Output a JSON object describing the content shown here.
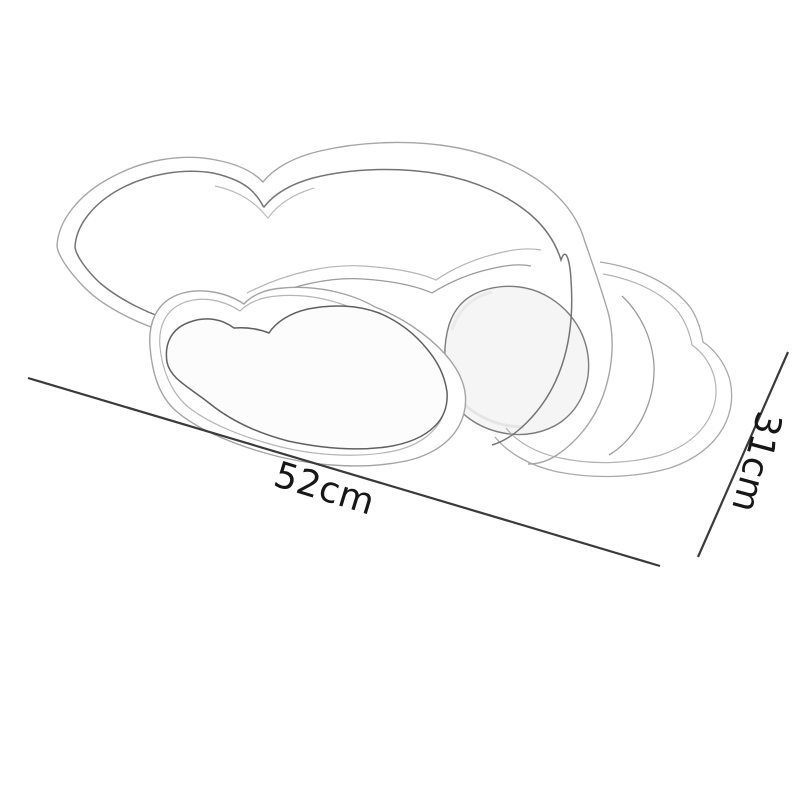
{
  "image": {
    "type": "product-dimension-diagram",
    "subject": "Cloud-shaped ceiling lamp, perspective line drawing of three overlapping cloud panels",
    "background_color": "#ffffff",
    "line_color_light": "#ababab",
    "line_color_dark": "#636363",
    "dimension_line_color": "#3a3a3a",
    "text_color": "#161616",
    "panel_tint": "#f5f5f5",
    "dimensions": {
      "width_label": "52cm",
      "depth_label": "31cm"
    }
  }
}
